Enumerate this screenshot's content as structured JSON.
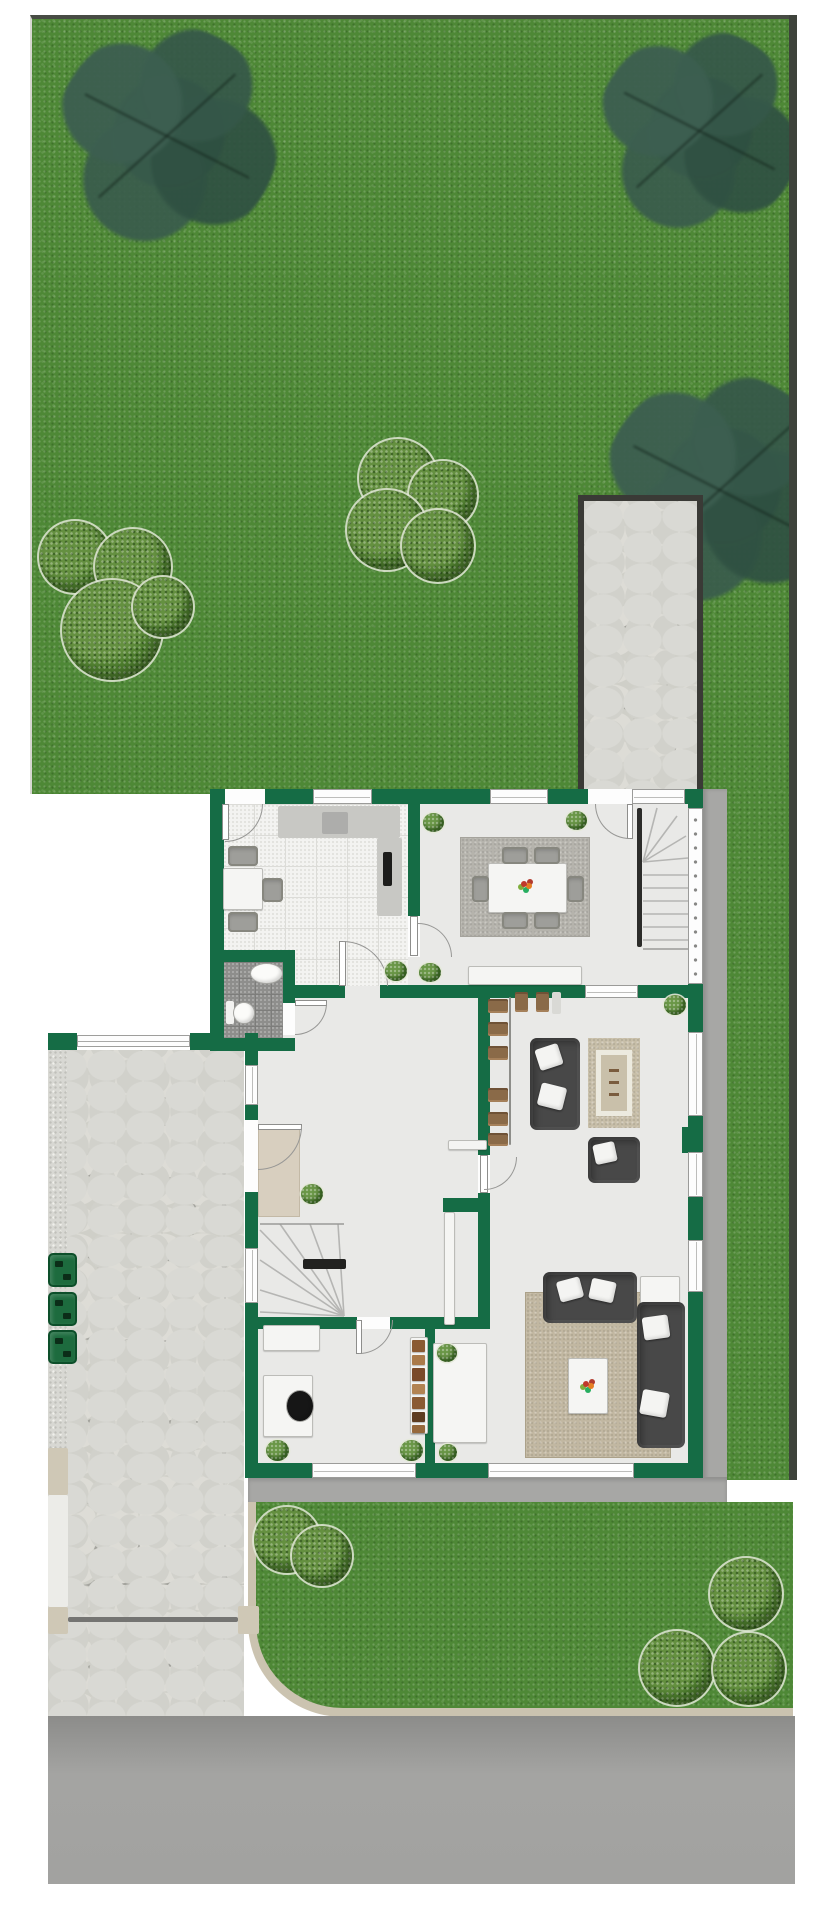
{
  "meta": {
    "kind": "residential-site-and-floor-plan",
    "view": "top-down",
    "visible_text": "none",
    "areas": [
      "backyard-lawn",
      "garden-path",
      "house-ground-floor",
      "side-lawn",
      "front-lawn",
      "stone-driveway",
      "street"
    ]
  },
  "colors": {
    "wall": "#156c45",
    "grass": "#4e8836",
    "tile": "#f3f3f1",
    "bath": "#8e8e8c",
    "floor": "#e9e9e7",
    "walkway": "#a7a7a5",
    "joint": "#a3a39d",
    "sofa": "#484848",
    "chair": "#9e9e9a",
    "bin": "#1d6b3e",
    "curb": "#cbc3b0",
    "darkedge": "#3e433b",
    "rug_large": "#c1b7a1",
    "rug_dining": "#b5b3ac",
    "rug_small": "#c6bda7",
    "mat": "#d8cfbf"
  },
  "scene": {
    "trees": [
      [
        135,
        118,
        112
      ],
      [
        667,
        113,
        103
      ],
      [
        688,
        472,
        118
      ]
    ],
    "bushes": [
      [
        75,
        557,
        36
      ],
      [
        133,
        567,
        38
      ],
      [
        112,
        630,
        50
      ],
      [
        163,
        607,
        30
      ],
      [
        398,
        478,
        39
      ],
      [
        443,
        495,
        34
      ],
      [
        387,
        530,
        40
      ],
      [
        438,
        546,
        36
      ],
      [
        287,
        1540,
        33
      ],
      [
        322,
        1556,
        30
      ],
      [
        746,
        1594,
        36
      ],
      [
        677,
        1668,
        37
      ],
      [
        749,
        1669,
        36
      ]
    ],
    "walls": [
      [
        210,
        789,
        493,
        15
      ],
      [
        210,
        789,
        14,
        261
      ],
      [
        190,
        1033,
        32,
        17
      ],
      [
        245,
        1033,
        13,
        444
      ],
      [
        245,
        1463,
        458,
        15
      ],
      [
        688,
        789,
        15,
        688
      ],
      [
        682,
        1127,
        7,
        26
      ],
      [
        408,
        804,
        12,
        112
      ],
      [
        295,
        985,
        50,
        13
      ],
      [
        380,
        985,
        205,
        13
      ],
      [
        638,
        985,
        50,
        13
      ],
      [
        213,
        950,
        82,
        12
      ],
      [
        283,
        950,
        12,
        53
      ],
      [
        210,
        1038,
        85,
        13
      ],
      [
        478,
        998,
        12,
        157
      ],
      [
        478,
        1193,
        12,
        136
      ],
      [
        443,
        1198,
        47,
        14
      ],
      [
        248,
        1317,
        109,
        12
      ],
      [
        390,
        1317,
        97,
        12
      ],
      [
        425,
        1329,
        10,
        134
      ],
      [
        48,
        1033,
        29,
        17
      ]
    ],
    "windows": [
      [
        313,
        789,
        59,
        15
      ],
      [
        490,
        789,
        58,
        15
      ],
      [
        632,
        789,
        53,
        15
      ],
      [
        245,
        1065,
        13,
        40
      ],
      [
        245,
        1248,
        13,
        55
      ],
      [
        312,
        1463,
        104,
        15
      ],
      [
        488,
        1463,
        146,
        15
      ],
      [
        688,
        1032,
        15,
        84
      ],
      [
        688,
        1152,
        15,
        45
      ],
      [
        688,
        1240,
        15,
        52
      ],
      [
        585,
        985,
        53,
        13
      ]
    ],
    "railwins": [
      [
        688,
        808,
        15,
        176
      ]
    ],
    "fences": [
      [
        77,
        1035,
        113,
        12
      ]
    ],
    "gaps": [
      [
        225,
        789,
        40,
        15
      ],
      [
        588,
        789,
        44,
        15
      ],
      [
        408,
        916,
        12,
        41
      ],
      [
        283,
        1003,
        12,
        32
      ],
      [
        245,
        1120,
        13,
        72
      ],
      [
        357,
        1317,
        33,
        12
      ],
      [
        478,
        1155,
        12,
        38
      ]
    ],
    "leaves": [
      [
        222,
        804,
        7,
        36
      ],
      [
        627,
        804,
        6,
        35
      ],
      [
        339,
        941,
        7,
        45
      ],
      [
        410,
        916,
        8,
        40
      ],
      [
        295,
        1000,
        32,
        6
      ],
      [
        258,
        1124,
        44,
        6
      ],
      [
        356,
        1320,
        6,
        34
      ],
      [
        480,
        1155,
        8,
        38
      ]
    ],
    "arcs": [
      [
        225,
        804,
        38,
        "br"
      ],
      [
        595,
        804,
        35,
        "bl"
      ],
      [
        343,
        941,
        45,
        "tr"
      ],
      [
        418,
        923,
        34,
        "tr"
      ],
      [
        295,
        1003,
        32,
        "br"
      ],
      [
        258,
        1126,
        44,
        "br"
      ],
      [
        359,
        1320,
        34,
        "br"
      ],
      [
        484,
        1157,
        33,
        "br"
      ]
    ],
    "slabs": [
      [
        278,
        806,
        122,
        32,
        "#c8c8c4",
        "kitchen-counter-top",
        0
      ],
      [
        377,
        838,
        25,
        78,
        "#c8c8c4",
        "kitchen-counter-side",
        0
      ],
      [
        322,
        812,
        26,
        22,
        "#adadab",
        "kitchen-sink",
        0
      ],
      [
        383,
        852,
        9,
        34,
        "#1d1d1b",
        "kitchen-tall-unit",
        0
      ],
      [
        637,
        808,
        5,
        139,
        "#2c2c2a",
        "stair-stringer",
        0
      ],
      [
        303,
        1259,
        43,
        10,
        "#222220",
        "basement-stair-handrail",
        0
      ],
      [
        68,
        1617,
        170,
        5,
        "#747472",
        "driveway-gate-bar",
        0
      ],
      [
        447,
        1368,
        7,
        72,
        "#101010",
        "television",
        4
      ],
      [
        279,
        1328,
        26,
        17,
        "#4a4a48",
        "printer",
        0
      ],
      [
        266,
        1396,
        12,
        11,
        "#6f8fa8",
        "laptop",
        0
      ],
      [
        265,
        1417,
        12,
        14,
        "#3a3a38",
        "desk-accessory",
        0
      ],
      [
        283,
        1386,
        8,
        38,
        "#141414",
        "office-chair-back",
        0
      ],
      [
        652,
        1288,
        16,
        16,
        "#c0c0bc",
        "side-table-tray",
        0
      ],
      [
        545,
        1099,
        20,
        15,
        "#8f8f8b",
        "sofa-throw",
        8
      ],
      [
        578,
        1283,
        18,
        16,
        "#9b9b97",
        "sofa-cushion-gray",
        5
      ],
      [
        645,
        1358,
        18,
        17,
        "#90908c",
        "sofa-cushion-gray",
        3
      ],
      [
        226,
        1001,
        8,
        23,
        "#f2f2f0",
        "toilet-tank",
        0
      ],
      [
        509,
        997,
        2,
        148,
        "#8e8e8a",
        "closet-rod",
        0
      ],
      [
        552,
        992,
        9,
        22,
        "#d9d9d5",
        "closet-shelf",
        0
      ],
      [
        48,
        1448,
        20,
        47,
        "#cfc8b6",
        "curb-post",
        0
      ],
      [
        48,
        1607,
        20,
        27,
        "#cfc8b6",
        "curb-post",
        0
      ],
      [
        238,
        1606,
        21,
        28,
        "#cfc8b6",
        "gate-post",
        0
      ],
      [
        48,
        1495,
        20,
        112,
        "#ecece8",
        "curb-strip",
        0
      ]
    ],
    "panels": [
      [
        488,
        863,
        79,
        50,
        "dining-table"
      ],
      [
        468,
        966,
        114,
        19,
        "dining-sideboard"
      ],
      [
        448,
        1140,
        39,
        10,
        "hall-sideboard"
      ],
      [
        444,
        1212,
        11,
        113,
        "storage-cabinet"
      ],
      [
        223,
        868,
        40,
        42,
        "kitchen-table"
      ],
      [
        263,
        1325,
        57,
        26,
        "printer-stand"
      ],
      [
        263,
        1375,
        50,
        62,
        "desk"
      ],
      [
        410,
        1337,
        18,
        97,
        "bookshelf"
      ],
      [
        433,
        1343,
        54,
        100,
        "tv-lowboard"
      ],
      [
        568,
        1358,
        40,
        56,
        "coffee-table"
      ],
      [
        640,
        1276,
        40,
        40,
        "side-table"
      ]
    ],
    "ovals": [
      [
        250,
        963,
        33,
        21,
        "#fbfbf9",
        "bathroom-sink"
      ],
      [
        233,
        1002,
        22,
        22,
        "#fbfbf9",
        "toilet-bowl"
      ],
      [
        286,
        1390,
        28,
        32,
        "#161616",
        "office-chair"
      ]
    ],
    "sofas": [
      [
        530,
        1038,
        50,
        92,
        "loveseat"
      ],
      [
        588,
        1137,
        52,
        46,
        "armchair"
      ],
      [
        543,
        1272,
        94,
        51,
        "sectional-sofa-top"
      ],
      [
        637,
        1302,
        48,
        146,
        "sectional-sofa-side"
      ]
    ],
    "pillows": [
      [
        537,
        1046,
        24,
        22,
        -18
      ],
      [
        539,
        1085,
        26,
        23,
        14
      ],
      [
        594,
        1143,
        22,
        20,
        -12
      ],
      [
        558,
        1279,
        24,
        21,
        -15
      ],
      [
        590,
        1280,
        25,
        21,
        12
      ],
      [
        643,
        1316,
        26,
        23,
        -8
      ],
      [
        641,
        1391,
        27,
        25,
        10
      ]
    ],
    "chairs": [
      [
        502,
        847,
        26,
        17
      ],
      [
        534,
        847,
        26,
        17
      ],
      [
        502,
        912,
        26,
        17
      ],
      [
        534,
        912,
        26,
        17
      ],
      [
        472,
        876,
        17,
        26
      ],
      [
        567,
        876,
        17,
        26
      ],
      [
        228,
        846,
        30,
        20
      ],
      [
        228,
        912,
        30,
        20
      ],
      [
        262,
        878,
        21,
        24
      ]
    ],
    "hangers": [
      [
        488,
        999,
        20,
        14
      ],
      [
        488,
        1022,
        20,
        14
      ],
      [
        488,
        1046,
        20,
        14
      ],
      [
        488,
        1088,
        20,
        14
      ],
      [
        488,
        1112,
        20,
        14
      ],
      [
        488,
        1133,
        20,
        13
      ],
      [
        515,
        992,
        13,
        20
      ],
      [
        536,
        992,
        13,
        20
      ]
    ],
    "books": [
      [
        412,
        1340,
        13,
        12,
        "#8a5a33"
      ],
      [
        412,
        1355,
        13,
        10,
        "#aa7a4a"
      ],
      [
        412,
        1368,
        13,
        13,
        "#7a4a2a"
      ],
      [
        412,
        1384,
        13,
        10,
        "#b28352"
      ],
      [
        412,
        1397,
        13,
        12,
        "#8a5a33"
      ],
      [
        412,
        1412,
        13,
        10,
        "#5e3d22"
      ],
      [
        412,
        1425,
        13,
        8,
        "#96683c"
      ]
    ],
    "plants": [
      [
        423,
        813,
        21,
        19
      ],
      [
        566,
        811,
        21,
        19
      ],
      [
        385,
        961,
        22,
        20
      ],
      [
        419,
        963,
        22,
        19
      ],
      [
        664,
        995,
        22,
        20
      ],
      [
        301,
        1184,
        22,
        20
      ],
      [
        437,
        1344,
        20,
        18
      ],
      [
        439,
        1444,
        18,
        17
      ],
      [
        266,
        1440,
        23,
        21
      ],
      [
        400,
        1440,
        23,
        21
      ]
    ],
    "bins": [
      [
        48,
        1253
      ],
      [
        48,
        1292
      ],
      [
        48,
        1330
      ]
    ],
    "flowers": [
      [
        521,
        881
      ],
      [
        583,
        1381
      ]
    ]
  }
}
